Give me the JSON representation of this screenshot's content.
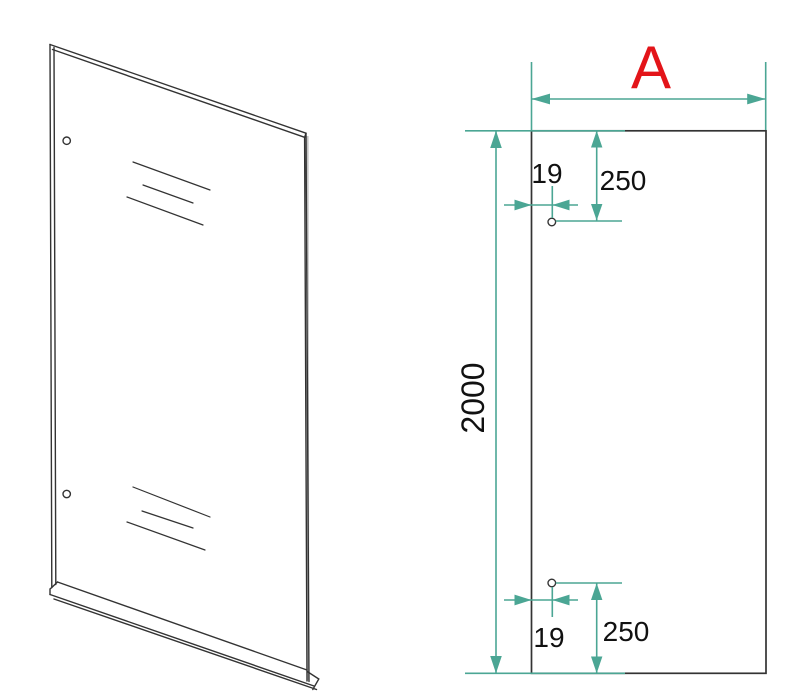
{
  "drawing": {
    "front": {
      "width_label": "A",
      "height_label": "2000",
      "top_hole": {
        "edge_offset_label": "19",
        "end_offset_label": "250"
      },
      "bottom_hole": {
        "edge_offset_label": "19",
        "end_offset_label": "250"
      }
    },
    "dimensions": {
      "height": 2000,
      "hole_edge_offset": 19,
      "hole_end_offset": 250,
      "width_symbol": "A"
    },
    "colors": {
      "dim": "#4BA694",
      "accent": "#E31419",
      "line": "#333333"
    }
  }
}
